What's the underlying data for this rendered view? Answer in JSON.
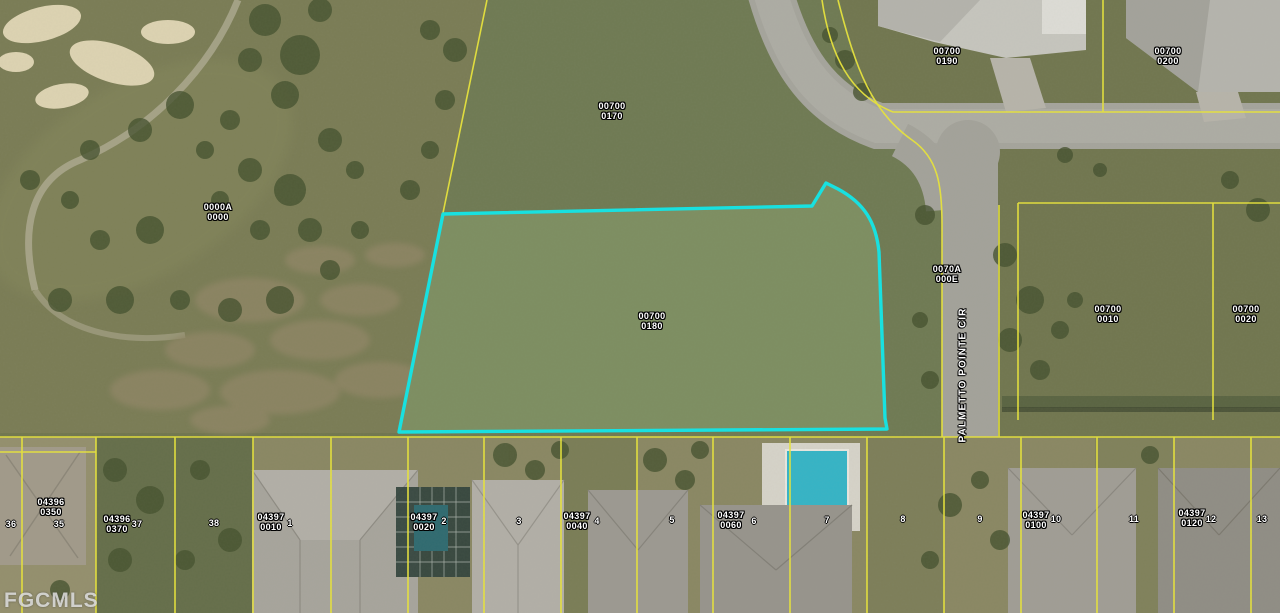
{
  "colors": {
    "subject_outline": "#14e3e3",
    "parcel_line": "#e8e43b",
    "pool": "#35b4c6",
    "label_text": "#ffffff"
  },
  "watermark": {
    "text": "FGCMLS"
  },
  "street": {
    "name": "PALMETTO POINTE CIR",
    "x": 963,
    "y": 375
  },
  "parcel_labels": [
    {
      "line1": "00700",
      "line2": "0170",
      "x": 612,
      "y": 111
    },
    {
      "line1": "00700",
      "line2": "0190",
      "x": 947,
      "y": 56
    },
    {
      "line1": "00700",
      "line2": "0200",
      "x": 1168,
      "y": 56
    },
    {
      "line1": "0000A",
      "line2": "0000",
      "x": 218,
      "y": 212
    },
    {
      "line1": "0070A",
      "line2": "000E",
      "x": 947,
      "y": 274
    },
    {
      "line1": "00700",
      "line2": "0180",
      "x": 652,
      "y": 321,
      "subject": true
    },
    {
      "line1": "00700",
      "line2": "0010",
      "x": 1108,
      "y": 314
    },
    {
      "line1": "00700",
      "line2": "0020",
      "x": 1246,
      "y": 314
    },
    {
      "line1": "04396",
      "line2": "0350",
      "x": 51,
      "y": 507
    },
    {
      "line1": "04396",
      "line2": "0370",
      "x": 117,
      "y": 524
    },
    {
      "line1": "04397",
      "line2": "0010",
      "x": 271,
      "y": 522
    },
    {
      "line1": "04397",
      "line2": "0020",
      "x": 424,
      "y": 522
    },
    {
      "line1": "04397",
      "line2": "0040",
      "x": 577,
      "y": 521
    },
    {
      "line1": "04397",
      "line2": "0060",
      "x": 731,
      "y": 520
    },
    {
      "line1": "04397",
      "line2": "0100",
      "x": 1036,
      "y": 520
    },
    {
      "line1": "04397",
      "line2": "0120",
      "x": 1192,
      "y": 518
    }
  ],
  "lot_numbers": [
    {
      "n": "36",
      "x": 11,
      "y": 524
    },
    {
      "n": "35",
      "x": 59,
      "y": 524
    },
    {
      "n": "37",
      "x": 137,
      "y": 524
    },
    {
      "n": "38",
      "x": 214,
      "y": 523
    },
    {
      "n": "1",
      "x": 290,
      "y": 523
    },
    {
      "n": "2",
      "x": 444,
      "y": 521
    },
    {
      "n": "3",
      "x": 519,
      "y": 521
    },
    {
      "n": "4",
      "x": 597,
      "y": 521
    },
    {
      "n": "5",
      "x": 672,
      "y": 520
    },
    {
      "n": "6",
      "x": 754,
      "y": 521
    },
    {
      "n": "7",
      "x": 827,
      "y": 520
    },
    {
      "n": "8",
      "x": 903,
      "y": 519
    },
    {
      "n": "9",
      "x": 980,
      "y": 519
    },
    {
      "n": "10",
      "x": 1056,
      "y": 519
    },
    {
      "n": "11",
      "x": 1134,
      "y": 519
    },
    {
      "n": "12",
      "x": 1211,
      "y": 519
    },
    {
      "n": "13",
      "x": 1262,
      "y": 519
    }
  ]
}
